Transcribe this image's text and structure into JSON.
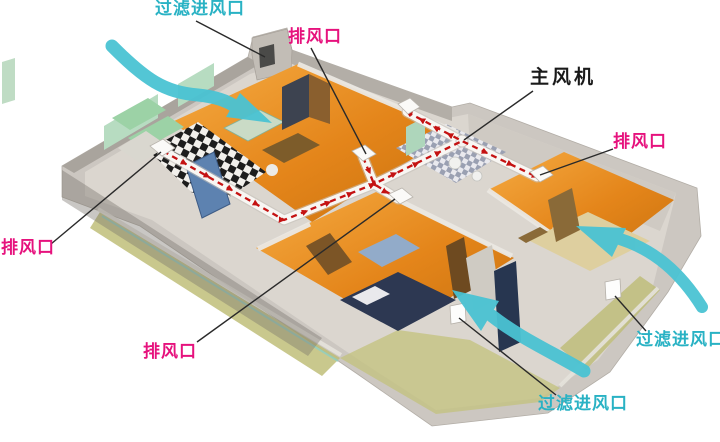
{
  "diagram": {
    "type": "home fresh-air ventilation system cutaway diagram",
    "background_color": "#ffffff",
    "annotations": {
      "inlet_top": {
        "text": "过滤进风口",
        "color": "#29b2c4"
      },
      "exhaust_top": {
        "text": "排风口",
        "color": "#e6127d"
      },
      "main_fan": {
        "text": "主风机",
        "color": "#1a1a1a"
      },
      "exhaust_right": {
        "text": "排风口",
        "color": "#e6127d"
      },
      "exhaust_left": {
        "text": "排风口",
        "color": "#e6127d"
      },
      "exhaust_bottom": {
        "text": "排风口",
        "color": "#e6127d"
      },
      "inlet_bottom": {
        "text": "过滤进风口",
        "color": "#29b2c4"
      },
      "inlet_right": {
        "text": "过滤进风口",
        "color": "#29b2c4"
      }
    },
    "colors": {
      "duct_arrow_red": "#c41212",
      "duct_tube_white": "#f8f6f3",
      "airflow_arrow_cyan": "#4ac3d3",
      "callout_line": "#2a2a2a",
      "floor_wood_orange": "#e4851a",
      "walls_gray": "#ccc7c1",
      "balcony_glass_olive": "#bdbc74",
      "glass_panel_green": "#b7dcc1"
    }
  }
}
